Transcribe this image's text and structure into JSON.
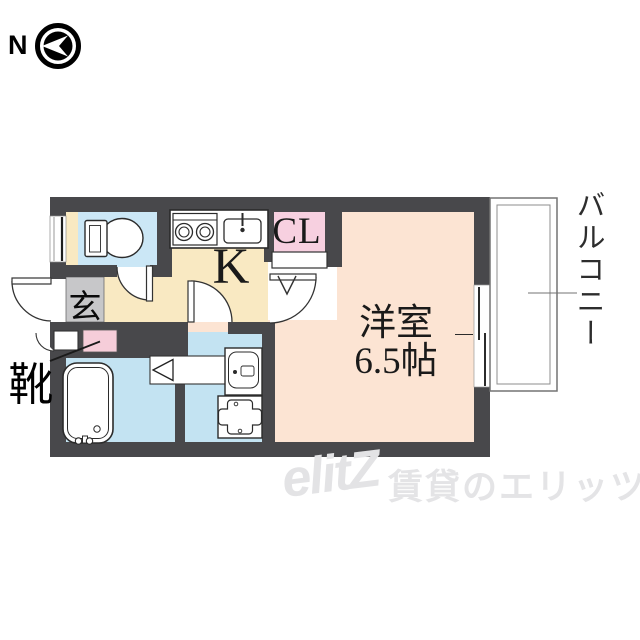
{
  "compass": {
    "label": "N",
    "direction": "north-points-left"
  },
  "rooms": {
    "kitchen": {
      "label": "K"
    },
    "closet": {
      "label": "CL"
    },
    "western_room": {
      "label": "洋室",
      "size": "6.5帖"
    },
    "entrance": {
      "label": "玄"
    },
    "shoes": {
      "label": "靴"
    },
    "balcony": {
      "label": "バルコニー"
    }
  },
  "fixtures": [
    "compass-icon",
    "toilet-icon",
    "stove-icon",
    "sink-icon",
    "bathtub-icon",
    "washbasin-icon",
    "washing-machine-icon",
    "door-swing-arcs",
    "sliding-window",
    "shoe-cabinet",
    "closet-folding-door"
  ],
  "watermark": {
    "logo": "elitZ",
    "text": "賃貸のエリッツ"
  },
  "colors": {
    "wall": "#48484b",
    "kitchen_floor": "#f9e9c2",
    "toilet_floor": "#cbe7f6",
    "bath_floor": "#c3e3f2",
    "closet": "#f7d0e0",
    "shoe_box": "#f6cdd9",
    "room_floor": "#fce4d3",
    "entrance_mat": "#c7c7c9",
    "watermark_gray": "#e3e3e5"
  }
}
